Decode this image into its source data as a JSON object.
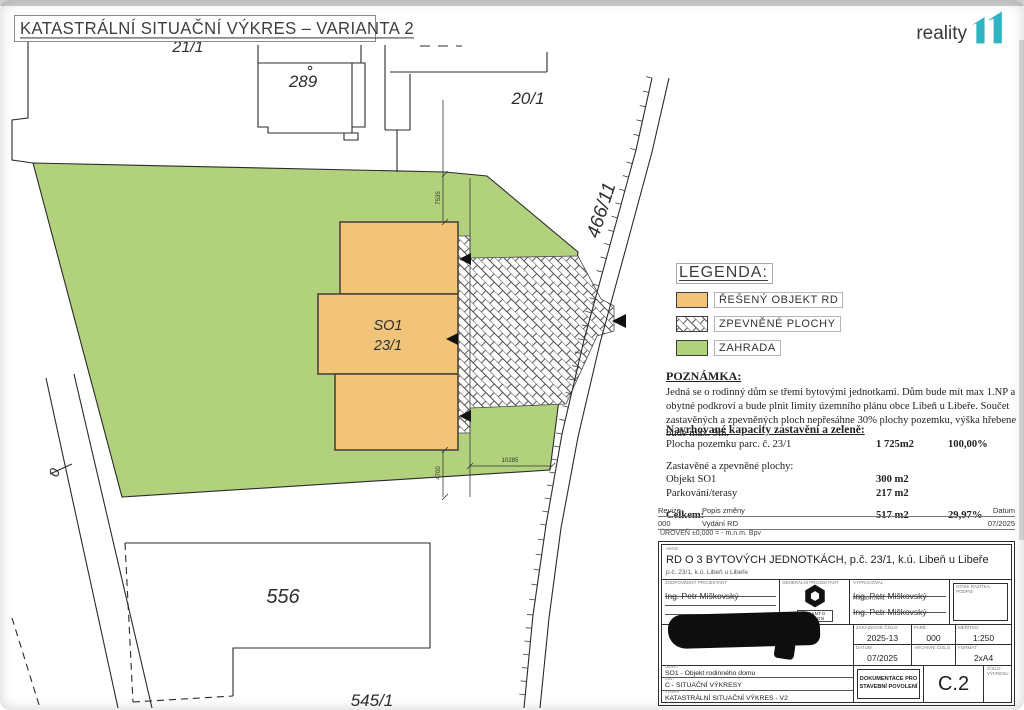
{
  "page": {
    "title": "KATASTRÁLNÍ SITUAČNÍ VÝKRES – VARIANTA 2",
    "logo": {
      "text": "reality",
      "mark": "11",
      "accent": "#2eb5c3"
    }
  },
  "plan": {
    "labels": {
      "building_top": "289",
      "parcel_upper": "21/1",
      "parcel_right": "20/1",
      "road": "466/11",
      "object1": "SO1",
      "object2": "23/1",
      "building_bottom": "556",
      "parcel_bottom": "545/1",
      "path0": "0"
    },
    "dims": {
      "top": "7535",
      "bottom": "4700",
      "width": "10285"
    },
    "colors": {
      "garden": "#b2d17d",
      "object": "#f2c479",
      "line": "#2b2b2b",
      "hatch_line": "#4a4a4a"
    }
  },
  "legend": {
    "title": "LEGENDA:",
    "items": [
      {
        "swatch": "orange-fill",
        "label": "ŘEŠENÝ OBJEKT RD"
      },
      {
        "swatch": "hatch-fill",
        "label": "ZPEVNĚNÉ PLOCHY"
      },
      {
        "swatch": "green-fill",
        "label": "ZAHRADA"
      }
    ]
  },
  "note": {
    "title": "POZNÁMKA:",
    "body": "Jedná se o rodinný dům se třemi bytovými jednotkami. Dům bude mít max 1.NP a obytné podkroví a bude plnit limity územního plánu obce Libeň u Libeře. Součet zastavěných a zpevněných ploch nepřesáhne 30% plochy pozemku, výška hřebene bude max. 9m."
  },
  "caps": {
    "title": "Navrhované kapacity zastavění a zeleně:",
    "rows": [
      {
        "label": "Plocha pozemku parc. č. 23/1",
        "value": "1 725m2",
        "pct": "100,00%"
      },
      {
        "label": "Zastavěné a zpevněné plochy:",
        "value": "",
        "pct": ""
      },
      {
        "label": "Objekt SO1",
        "value": "300 m2",
        "pct": ""
      },
      {
        "label": "Parkování/terasy",
        "value": "217 m2",
        "pct": ""
      },
      {
        "label": "Celkem:",
        "value": "517 m2",
        "pct": "29,97%"
      }
    ]
  },
  "revisions": {
    "headers": [
      "Revize",
      "Popis změny",
      "Datum"
    ],
    "rows": [
      [
        "000",
        "Vydání RD",
        "07/2025"
      ]
    ],
    "level": "ÚROVEŇ ±0,000 = - m.n.m. Bpv"
  },
  "titleblock": {
    "header_label": "AKCE",
    "project": "RD O 3 BYTOVÝCH JEDNOTKÁCH, p.č. 23/1, k.ú. Libeň u Libeře",
    "project_sub": "p.č. 23/1, k.ú. Libeň u Libeře",
    "cells": {
      "responsible": {
        "label": "ZODPOVĚDNÝ PROJEKTANT",
        "value": "Ing. Petr Miškovský"
      },
      "company": {
        "label": "GENERÁLNÍ PROJEKTANT",
        "name": "QUANTO DESIGN"
      },
      "drafted": {
        "label": "VYPRACOVAL",
        "value": "Ing. Petr Miškovský"
      },
      "designed": {
        "label": "PROJEKTOVAL",
        "value": "Ing. Petr Miškovský"
      },
      "stamp": {
        "label": "OTISK RAZÍTKA, PODPIS"
      },
      "job_number": {
        "label": "ZAKÁZKOVÉ ČÍSLO",
        "value": "2025-13"
      },
      "pare": {
        "label": "PARÉ",
        "value": "000"
      },
      "scale": {
        "label": "MĚŘÍTKO",
        "value": "1:250"
      },
      "date": {
        "label": "DATUM",
        "value": "07/2025"
      },
      "archive": {
        "label": "ARCHIVNÍ ČÍSLO",
        "value": ""
      },
      "format": {
        "label": "FORMÁT",
        "value": "2xA4"
      },
      "object": {
        "label": "OBJEKT",
        "value": "SO1 - Objekt rodinného domu"
      },
      "part": {
        "label": "ČÁST",
        "value": "C - SITUAČNÍ VÝKRESY"
      },
      "drawing": {
        "label": "VÝKRES",
        "value": "KATASTRÁLNÍ SITUAČNÍ VÝKRES - V2"
      },
      "stage": {
        "label": "STUPEŇ",
        "value": "DOKUMENTACE PRO STAVEBNÍ POVOLENÍ"
      },
      "number": {
        "label": "ČÍSLO VÝKRESU",
        "value": "C.2"
      }
    }
  }
}
